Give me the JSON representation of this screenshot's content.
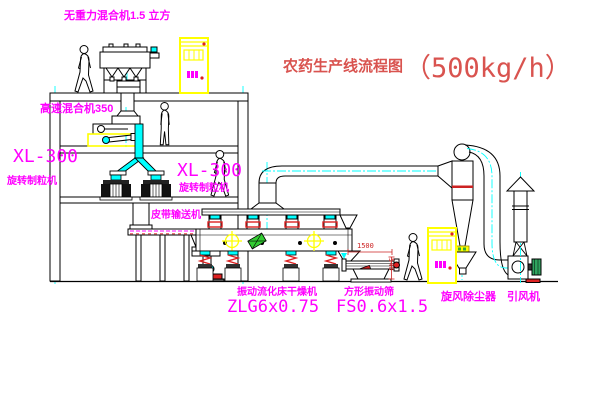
{
  "title": {
    "name": "农药生产线流程图",
    "capacity": "（500kg/h）"
  },
  "labels": {
    "gravity_mixer": "无重力混合机1.5 立方",
    "high_speed_mixer": "高速混合机350",
    "granulator_left": {
      "model": "XL-300",
      "name": "旋转制粒机"
    },
    "granulator_right": {
      "model": "XL-300",
      "name": "旋转制粒机"
    },
    "belt_conveyor": "皮带输送机",
    "fluid_bed_dryer": {
      "name": "振动流化床干燥机",
      "model": "ZLG6x0.75"
    },
    "vibrating_screen": {
      "name": "方形振动筛",
      "model": "FS0.6x1.5"
    },
    "cyclone": "旋风除尘器",
    "induced_draft_fan": "引风机"
  },
  "dimensions": {
    "screen_length": "1500",
    "screen_height": "540"
  },
  "colors": {
    "label": "#FF00FF",
    "title": "#D9534F",
    "centerline": "#00FFFF",
    "dimension": "#CC2222",
    "cabinet": "#FFFF00",
    "clamp_red": "#DD2222",
    "motor_green": "#2FA45F"
  }
}
